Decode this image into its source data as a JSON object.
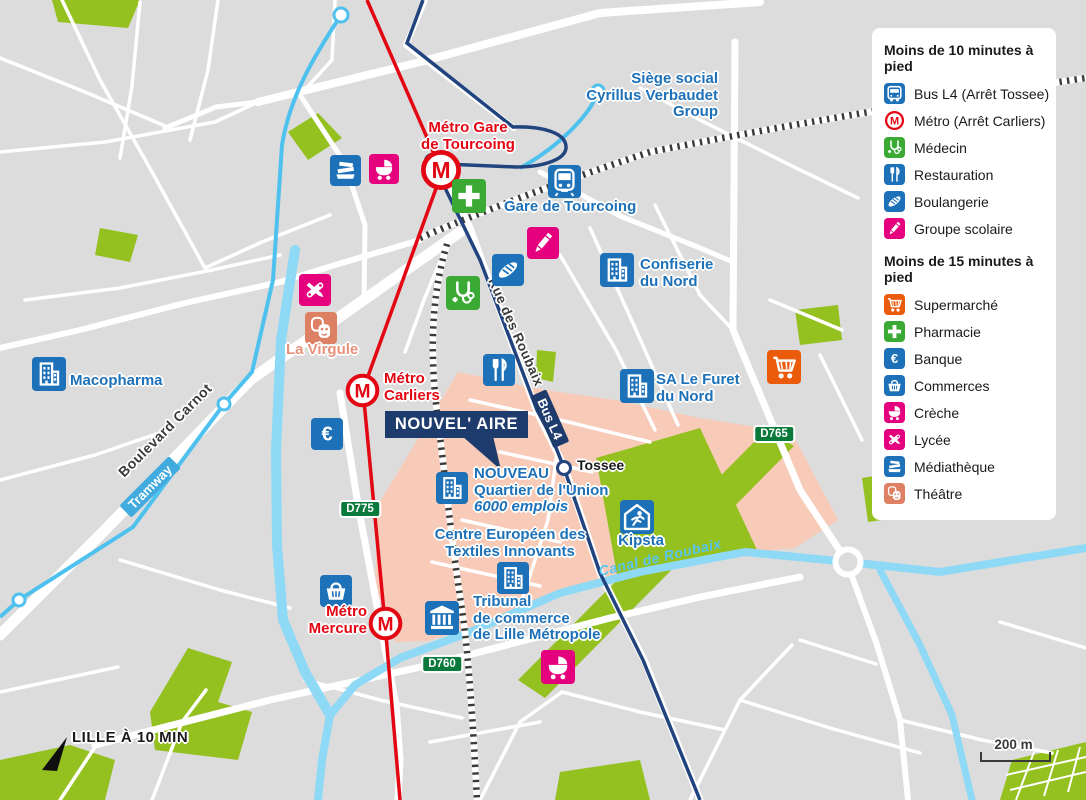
{
  "colors": {
    "background": "#dcdcdc",
    "road": "#ffffff",
    "park_green": "#94c11f",
    "district_salmon": "#f8cab8",
    "navy": "#1d3c6d",
    "metro_red": "#e30613",
    "brand_blue": "#1d71b8",
    "health_green": "#3aaa35",
    "pink": "#e5007d",
    "orange": "#ea5b0c",
    "theatre_salmon": "#dd8064",
    "tram_blue": "#4fc1ee",
    "canal_blue": "#8ed9f6",
    "badge_green": "#0a7a3c",
    "text_dark": "#3a3a39"
  },
  "legend": {
    "sections": [
      {
        "title": "Moins de 10 minutes à pied",
        "items": [
          {
            "name": "legend-item-bus",
            "icon": "bus",
            "color": "#1d71b8",
            "label": "Bus L4 (Arrêt Tossee)"
          },
          {
            "name": "legend-item-metro",
            "icon": "metro",
            "color": "#e30613",
            "label": "Métro (Arrêt Carliers)"
          },
          {
            "name": "legend-item-medecin",
            "icon": "medecin",
            "color": "#3aaa35",
            "label": "Médecin"
          },
          {
            "name": "legend-item-restauration",
            "icon": "restauration",
            "color": "#1d71b8",
            "label": "Restauration"
          },
          {
            "name": "legend-item-boulangerie",
            "icon": "boulangerie",
            "color": "#1d71b8",
            "label": "Boulangerie"
          },
          {
            "name": "legend-item-groupe-scolaire",
            "icon": "groupe-scolaire",
            "color": "#e5007d",
            "label": "Groupe scolaire"
          }
        ]
      },
      {
        "title": "Moins de 15 minutes à pied",
        "items": [
          {
            "name": "legend-item-supermarche",
            "icon": "supermarche",
            "color": "#ea5b0c",
            "label": "Supermarché"
          },
          {
            "name": "legend-item-pharmacie",
            "icon": "pharmacie",
            "color": "#3aaa35",
            "label": "Pharmacie"
          },
          {
            "name": "legend-item-banque",
            "icon": "banque",
            "color": "#1d71b8",
            "label": "Banque"
          },
          {
            "name": "legend-item-commerces",
            "icon": "commerces",
            "color": "#1d71b8",
            "label": "Commerces"
          },
          {
            "name": "legend-item-creche",
            "icon": "creche",
            "color": "#e5007d",
            "label": "Crèche"
          },
          {
            "name": "legend-item-lycee",
            "icon": "lycee",
            "color": "#e5007d",
            "label": "Lycée"
          },
          {
            "name": "legend-item-mediatheque",
            "icon": "mediatheque",
            "color": "#1d71b8",
            "label": "Médiathèque"
          },
          {
            "name": "legend-item-theatre",
            "icon": "theatre",
            "color": "#dd8064",
            "label": "Théâtre"
          }
        ]
      }
    ]
  },
  "callout": {
    "text": "NOUVEL' AIRE"
  },
  "compass": {
    "text": "LILLE À 10 MIN"
  },
  "scalebar": {
    "text": "200 m"
  },
  "markers": [
    {
      "name": "marker-mediatheque",
      "icon": "mediatheque",
      "color": "#1d71b8",
      "x": 345,
      "y": 170,
      "size": 31
    },
    {
      "name": "marker-creche-nord",
      "icon": "creche",
      "color": "#e5007d",
      "x": 384,
      "y": 169,
      "size": 30
    },
    {
      "name": "marker-metro-gare-tourcoing",
      "icon": "metro",
      "color": "#e30613",
      "x": 441,
      "y": 170,
      "size": 44
    },
    {
      "name": "marker-pharmacie",
      "icon": "pharmacie",
      "color": "#3aaa35",
      "x": 469,
      "y": 196,
      "size": 34
    },
    {
      "name": "marker-gare-train",
      "icon": "train",
      "color": "#1d71b8",
      "x": 564,
      "y": 181,
      "size": 33
    },
    {
      "name": "marker-groupe-scolaire",
      "icon": "groupe-scolaire",
      "color": "#e5007d",
      "x": 543,
      "y": 243,
      "size": 32
    },
    {
      "name": "marker-boulangerie",
      "icon": "boulangerie",
      "color": "#1d71b8",
      "x": 508,
      "y": 270,
      "size": 32
    },
    {
      "name": "marker-building-confiserie",
      "icon": "building",
      "color": "#1d71b8",
      "x": 617,
      "y": 270,
      "size": 34
    },
    {
      "name": "marker-medecin",
      "icon": "medecin",
      "color": "#3aaa35",
      "x": 463,
      "y": 293,
      "size": 34
    },
    {
      "name": "marker-lycee",
      "icon": "lycee",
      "color": "#e5007d",
      "x": 315,
      "y": 290,
      "size": 32
    },
    {
      "name": "marker-theatre",
      "icon": "theatre",
      "color": "#dd8064",
      "x": 321,
      "y": 328,
      "size": 32
    },
    {
      "name": "marker-building-macopharma",
      "icon": "building",
      "color": "#1d71b8",
      "x": 49,
      "y": 374,
      "size": 34
    },
    {
      "name": "marker-restauration",
      "icon": "restauration",
      "color": "#1d71b8",
      "x": 499,
      "y": 370,
      "size": 32
    },
    {
      "name": "marker-building-furet",
      "icon": "building",
      "color": "#1d71b8",
      "x": 637,
      "y": 386,
      "size": 34
    },
    {
      "name": "marker-metro-carliers",
      "icon": "metro",
      "color": "#e30613",
      "x": 362,
      "y": 390,
      "size": 37
    },
    {
      "name": "marker-banque",
      "icon": "banque",
      "color": "#1d71b8",
      "x": 327,
      "y": 434,
      "size": 32
    },
    {
      "name": "marker-supermarche",
      "icon": "supermarche",
      "color": "#ea5b0c",
      "x": 784,
      "y": 367,
      "size": 34
    },
    {
      "name": "marker-building-nouveau",
      "icon": "building",
      "color": "#1d71b8",
      "x": 452,
      "y": 488,
      "size": 32
    },
    {
      "name": "marker-kipsta",
      "icon": "kipsta",
      "color": "#1d71b8",
      "x": 637,
      "y": 517,
      "size": 34
    },
    {
      "name": "marker-building-ceti",
      "icon": "building",
      "color": "#1d71b8",
      "x": 513,
      "y": 578,
      "size": 32
    },
    {
      "name": "marker-commerces",
      "icon": "commerces",
      "color": "#1d71b8",
      "x": 336,
      "y": 591,
      "size": 32
    },
    {
      "name": "marker-metro-mercure",
      "icon": "metro",
      "color": "#e30613",
      "x": 385,
      "y": 623,
      "size": 37
    },
    {
      "name": "marker-tribunal",
      "icon": "tribunal",
      "color": "#1d71b8",
      "x": 442,
      "y": 618,
      "size": 34
    },
    {
      "name": "marker-creche-sud",
      "icon": "creche",
      "color": "#e5007d",
      "x": 558,
      "y": 667,
      "size": 34
    }
  ],
  "labels": [
    {
      "name": "label-metro-gare-tourcoing",
      "lines": [
        "Métro Gare",
        "de Tourcoing"
      ],
      "color": "#e30613",
      "x": 468,
      "y": 120,
      "align": "center",
      "size": 15
    },
    {
      "name": "label-gare-de-tourcoing",
      "lines": [
        "Gare de Tourcoing"
      ],
      "color": "#1d71b8",
      "x": 504,
      "y": 199,
      "align": "left",
      "size": 15
    },
    {
      "name": "label-siege-social",
      "lines": [
        "Siège social",
        "Cyrillus Verbaudet",
        "Group"
      ],
      "color": "#1d71b8",
      "x": 718,
      "y": 71,
      "align": "right",
      "size": 15
    },
    {
      "name": "label-confiserie-du-nord",
      "lines": [
        "Confiserie",
        "du Nord"
      ],
      "color": "#1d71b8",
      "x": 640,
      "y": 257,
      "align": "left",
      "size": 15
    },
    {
      "name": "label-sa-le-furet-du-nord",
      "lines": [
        "SA Le Furet",
        "du Nord"
      ],
      "color": "#1d71b8",
      "x": 656,
      "y": 372,
      "align": "left",
      "size": 15
    },
    {
      "name": "label-macopharma",
      "lines": [
        "Macopharma"
      ],
      "color": "#1d71b8",
      "x": 70,
      "y": 373,
      "align": "left",
      "size": 15
    },
    {
      "name": "label-la-virgule",
      "lines": [
        "La Virgule"
      ],
      "color": "#e8917a",
      "x": 286,
      "y": 342,
      "align": "left",
      "size": 15
    },
    {
      "name": "label-metro-carliers",
      "lines": [
        "Métro",
        "Carliers"
      ],
      "color": "#e30613",
      "x": 384,
      "y": 371,
      "align": "left",
      "size": 15
    },
    {
      "name": "label-nouveau-quartier",
      "lines": [
        "NOUVEAU",
        "Quartier de l'Union",
        "6000 emplois"
      ],
      "color": "#1d71b8",
      "x": 474,
      "y": 466,
      "align": "left",
      "size": 15,
      "italic_lines": [
        3
      ]
    },
    {
      "name": "label-centre-europeen",
      "lines": [
        "Centre Européen des",
        "Textiles Innovants"
      ],
      "color": "#1d71b8",
      "x": 510,
      "y": 527,
      "align": "center",
      "size": 15
    },
    {
      "name": "label-kipsta",
      "lines": [
        "Kipsta"
      ],
      "color": "#1d71b8",
      "x": 641,
      "y": 533,
      "align": "center",
      "size": 15
    },
    {
      "name": "label-tribunal",
      "lines": [
        "Tribunal",
        "de commerce",
        "de Lille Métropole"
      ],
      "color": "#1d71b8",
      "x": 473,
      "y": 594,
      "align": "left",
      "size": 15
    },
    {
      "name": "label-metro-mercure",
      "lines": [
        "Métro",
        "Mercure"
      ],
      "color": "#e30613",
      "x": 367,
      "y": 604,
      "align": "right",
      "size": 15
    },
    {
      "name": "label-tossee",
      "lines": [
        "Tossee"
      ],
      "color": "#1a1a1a",
      "x": 577,
      "y": 458,
      "align": "left",
      "size": 14
    }
  ],
  "street_labels": [
    {
      "name": "label-boulevard-carnot",
      "text": "Boulevard Carnot",
      "x": 165,
      "y": 430,
      "rotate": -45,
      "color": "#3a3a39",
      "size": 14,
      "italic": false
    },
    {
      "name": "label-rue-des-roubaix",
      "text": "Rue des Roubaix",
      "x": 516,
      "y": 332,
      "rotate": 66,
      "color": "#3a3a39",
      "size": 13.5,
      "italic": false
    },
    {
      "name": "label-canal-de-roubaix",
      "text": "Canal de Roubaix",
      "x": 660,
      "y": 557,
      "rotate": -13,
      "color": "#57c5f0",
      "size": 14,
      "italic": true
    }
  ],
  "line_labels": [
    {
      "name": "label-tramway",
      "text": "Tramway",
      "x": 150,
      "y": 487,
      "rotate": -45,
      "bg": "#41aadf"
    },
    {
      "name": "label-bus-l4",
      "text": "Bus L4",
      "x": 550,
      "y": 419,
      "rotate": 66,
      "bg": "#1d3c6d"
    }
  ],
  "road_badges": [
    {
      "name": "badge-d775",
      "text": "D775",
      "x": 360,
      "y": 509
    },
    {
      "name": "badge-d760",
      "text": "D760",
      "x": 442,
      "y": 664
    },
    {
      "name": "badge-d765",
      "text": "D765",
      "x": 774,
      "y": 434
    }
  ]
}
